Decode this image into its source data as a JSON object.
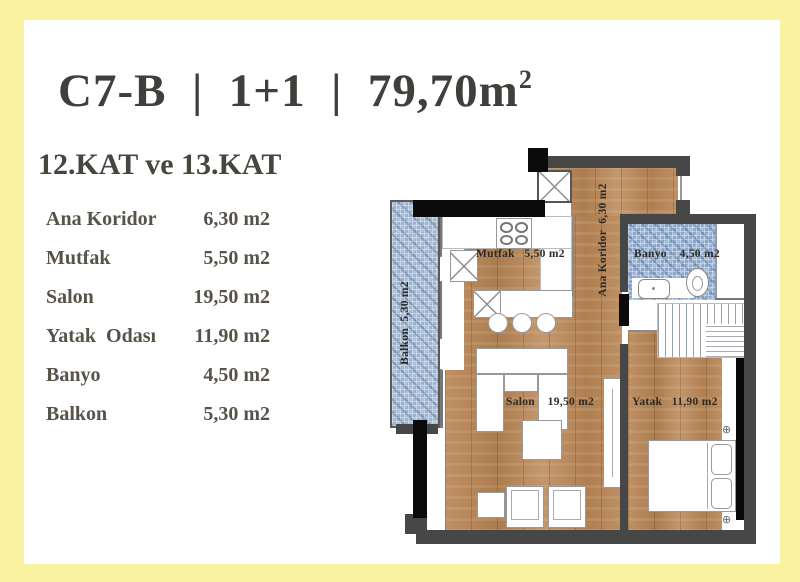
{
  "frame": {
    "border_color": "#f9f2a0",
    "background": "#ffffff"
  },
  "header": {
    "title_main": "C7-B  |  1+1  |  79,70m",
    "title_sup": "2",
    "subtitle": "12.KAT ve 13.KAT"
  },
  "room_list": {
    "rows": [
      {
        "name": "Ana Koridor",
        "area": "6,30 m2"
      },
      {
        "name": "Mutfak",
        "area": "5,50 m2"
      },
      {
        "name": "Salon",
        "area": "19,50 m2"
      },
      {
        "name": "Yatak  Odası",
        "area": "11,90 m2"
      },
      {
        "name": "Banyo",
        "area": "4,50 m2"
      },
      {
        "name": "Balkon",
        "area": "5,30 m2"
      }
    ]
  },
  "floorplan": {
    "labels": {
      "balcony": "Balkon  5,30 m2",
      "kitchen": "Mutfak   5,50 m2",
      "corridor": "Ana Koridor  6,30 m2",
      "bathroom": "Banyo    4,50 m2",
      "living": "Salon    19,50 m2",
      "bedroom": "Yatak   11,90 m2"
    },
    "colors": {
      "wall": "#474747",
      "wall_accent": "#0b0b0b",
      "wood": "#b8895b",
      "tile": "#8ba6c9",
      "label_text": "#2d2a25"
    }
  }
}
